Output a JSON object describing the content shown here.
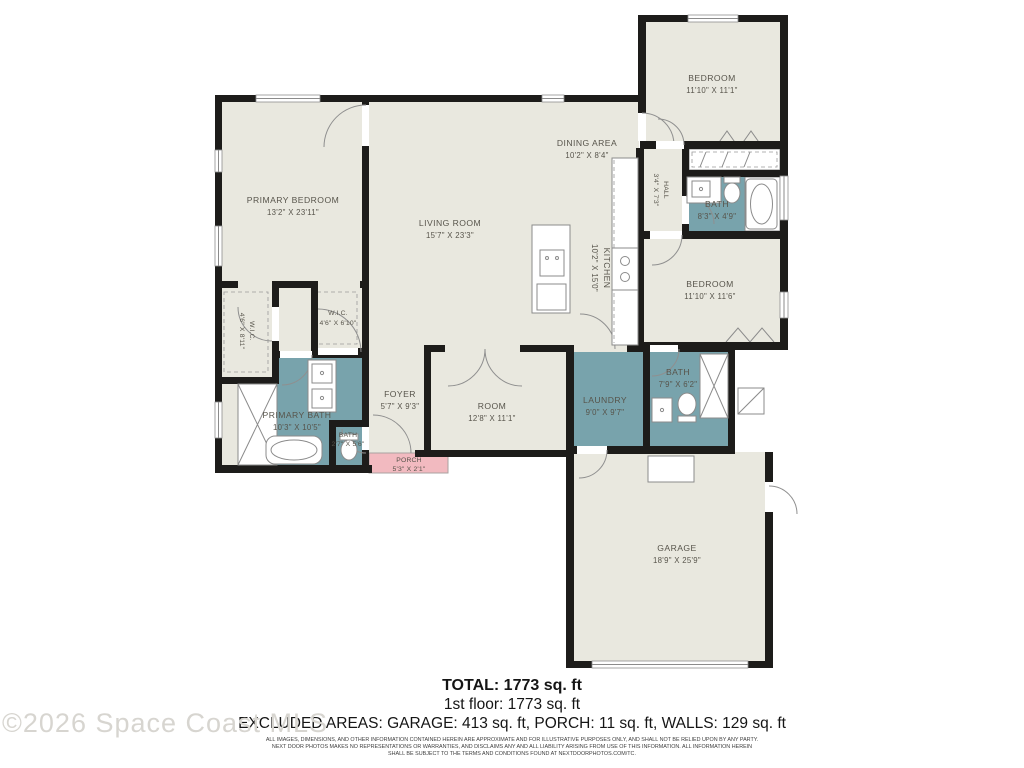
{
  "floorplan": {
    "rooms": {
      "primary_bedroom": {
        "name": "PRIMARY BEDROOM",
        "dims": "13'2\" X 23'11\""
      },
      "living_room": {
        "name": "LIVING ROOM",
        "dims": "15'7\" X 23'3\""
      },
      "dining_area": {
        "name": "DINING AREA",
        "dims": "10'2\" X 8'4\""
      },
      "kitchen": {
        "name": "KITCHEN",
        "dims": "10'2\" X 15'0\""
      },
      "bedroom_top": {
        "name": "BEDROOM",
        "dims": "11'10\" X 11'1\""
      },
      "hall": {
        "name": "HALL",
        "dims": "3'4\" X 7'3\""
      },
      "bath_hall": {
        "name": "BATH",
        "dims": "8'3\" X 4'9\""
      },
      "bedroom_right": {
        "name": "BEDROOM",
        "dims": "11'10\" X 11'6\""
      },
      "wic_left": {
        "name": "W.I.C.",
        "dims": "4'6\" X 8'11\""
      },
      "wic_right": {
        "name": "W.I.C.",
        "dims": "4'6\" X 6'10\""
      },
      "primary_bath": {
        "name": "PRIMARY BATH",
        "dims": "10'3\" X 10'5\""
      },
      "bath_small": {
        "name": "BATH",
        "dims": "2'7\" X 5'6\""
      },
      "foyer": {
        "name": "FOYER",
        "dims": "5'7\" X 9'3\""
      },
      "room": {
        "name": "ROOM",
        "dims": "12'8\" X 11'1\""
      },
      "laundry": {
        "name": "LAUNDRY",
        "dims": "9'0\" X 9'7\""
      },
      "bath_mid": {
        "name": "BATH",
        "dims": "7'9\" X 6'2\""
      },
      "porch": {
        "name": "PORCH",
        "dims": "5'3\" X 2'1\""
      },
      "garage": {
        "name": "GARAGE",
        "dims": "18'9\" X 25'9\""
      }
    },
    "colors": {
      "room_fill": "#e9e8df",
      "bath_fill": "#78a3ac",
      "porch_fill": "#f2bac0",
      "wall": "#1d1c1a"
    }
  },
  "footer": {
    "total": "TOTAL: 1773 sq. ft",
    "floor1": "1st floor: 1773 sq. ft",
    "excluded": "EXCLUDED AREAS: GARAGE: 413 sq. ft, PORCH: 11 sq. ft, WALLS: 129 sq. ft",
    "disclaimer_line1": "ALL IMAGES, DIMENSIONS, AND OTHER INFORMATION CONTAINED HEREIN ARE APPROXIMATE AND FOR ILLUSTRATIVE PURPOSES ONLY, AND SHALL NOT BE RELIED UPON BY ANY PARTY.",
    "disclaimer_line2": "NEXT DOOR PHOTOS MAKES NO REPRESENTATIONS OR WARRANTIES, AND DISCLAIMS ANY AND ALL LIABILITY ARISING FROM USE OF THIS INFORMATION. ALL INFORMATION HEREIN",
    "disclaimer_line3": "SHALL BE SUBJECT TO THE TERMS AND CONDITIONS FOUND AT NEXTDOORPHOTOS.COM/TC."
  },
  "watermark": "©2026 Space Coast MLS"
}
